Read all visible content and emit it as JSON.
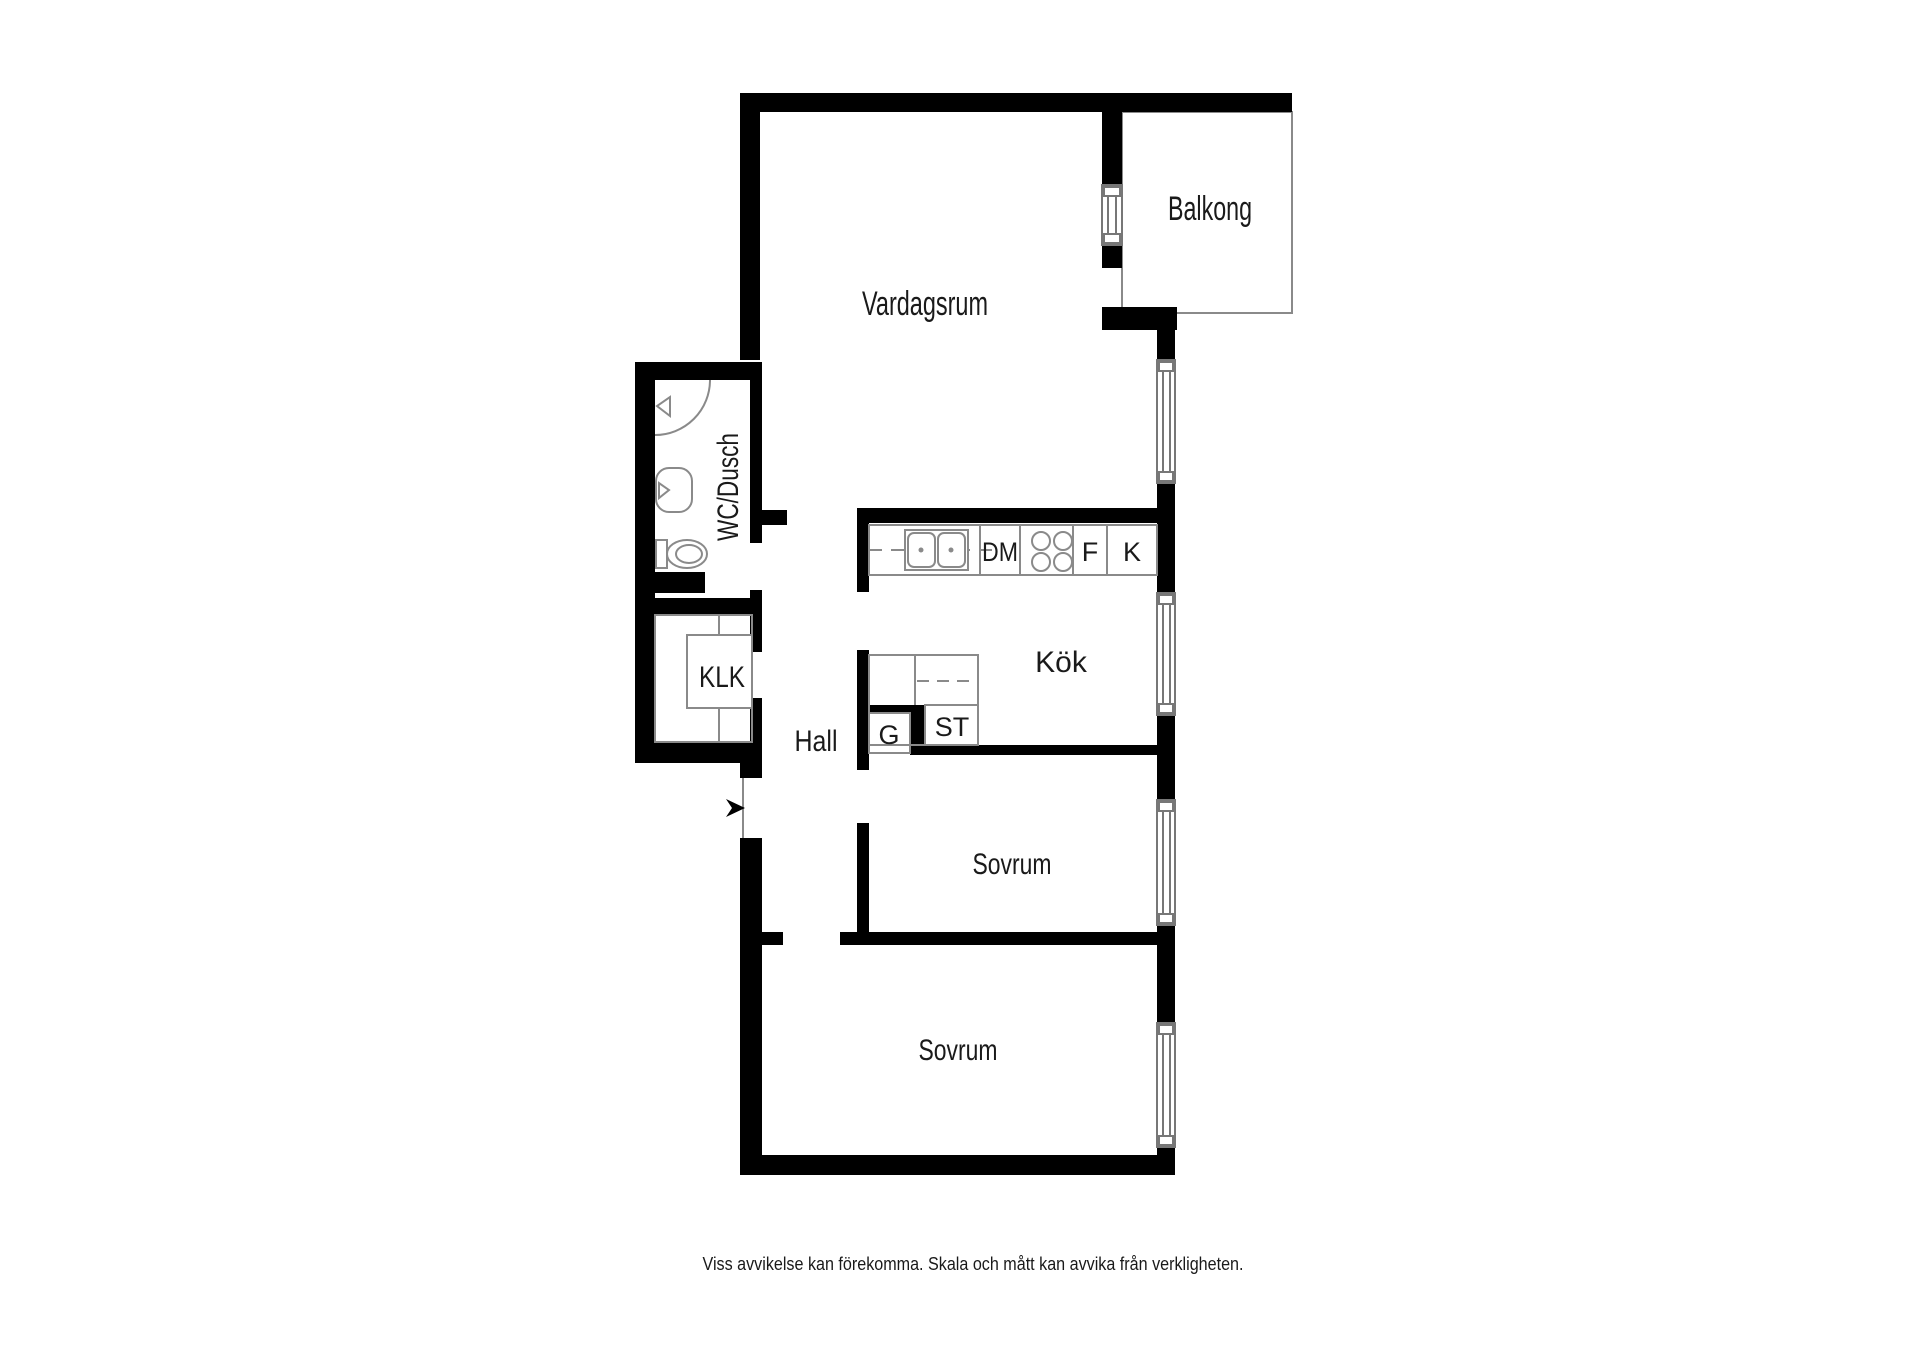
{
  "floorplan": {
    "rooms": {
      "vardagsrum": "Vardagsrum",
      "balkong": "Balkong",
      "wc_dusch": "WC/Dusch",
      "kok": "Kök",
      "klk": "KLK",
      "hall": "Hall",
      "sovrum_1": "Sovrum",
      "sovrum_2": "Sovrum"
    },
    "fixtures": {
      "dm": "DM",
      "f": "F",
      "k": "K",
      "g": "G",
      "st": "ST"
    },
    "colors": {
      "wall": "#000000",
      "thin_line": "#8a8a8a",
      "text": "#1a1a1a",
      "background": "#ffffff"
    },
    "disclaimer": "Viss avvikelse kan förekomma. Skala och mått kan avvika från verkligheten."
  }
}
